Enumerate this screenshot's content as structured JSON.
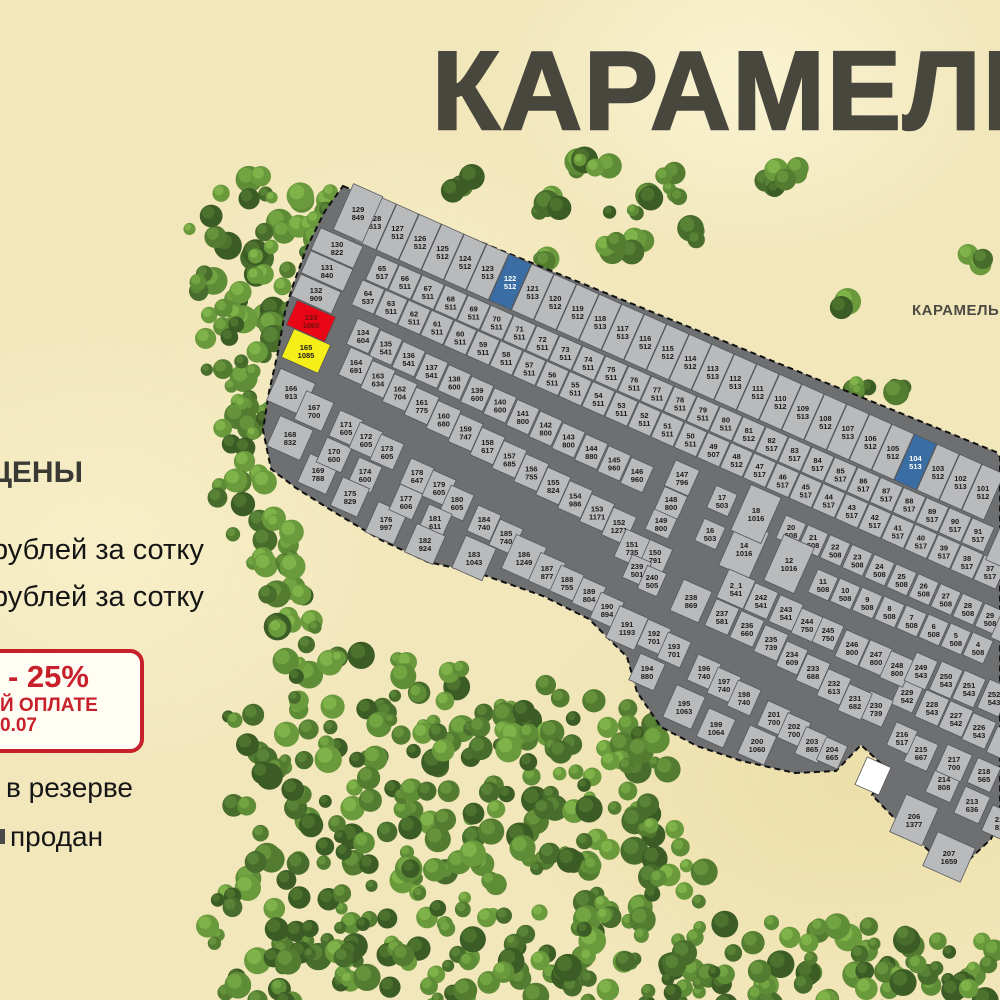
{
  "title": "КАРАМЕЛЬ",
  "secondary_area_label": "КАРАМЕЛЬ 2",
  "legend": {
    "prices_heading": "ЦЕНЫ",
    "price_line_1": "рублей за сотку",
    "price_line_2": "рублей за сотку",
    "promo": {
      "discount": "- 25%",
      "payment": "Й ОПЛАТЕ",
      "date": "0.07"
    },
    "status_reserved": "в резерве",
    "status_sold": "продан"
  },
  "colors": {
    "plot": "#b9babc",
    "road": "#6d6f71",
    "reserved_blue": "#3a6da4",
    "highlight_red": "#e80515",
    "highlight_yellow": "#f6ee19",
    "sold_white": "#ffffff",
    "promo_red": "#c8202a",
    "title_gray": "#48473e"
  },
  "map": {
    "plots": [
      [
        "129",
        "849"
      ],
      [
        "128",
        "513"
      ],
      [
        "127",
        "512"
      ],
      [
        "126",
        "512"
      ],
      [
        "125",
        "512"
      ],
      [
        "124",
        "512"
      ],
      [
        "123",
        "513"
      ],
      [
        "122",
        "512",
        "blue"
      ],
      [
        "121",
        "513"
      ],
      [
        "120",
        "512"
      ],
      [
        "119",
        "512"
      ],
      [
        "118",
        "513"
      ],
      [
        "117",
        "513"
      ],
      [
        "116",
        "512"
      ],
      [
        "115",
        "512"
      ],
      [
        "114",
        "512"
      ],
      [
        "113",
        "513"
      ],
      [
        "112",
        "513"
      ],
      [
        "111",
        "512"
      ],
      [
        "110",
        "512"
      ],
      [
        "109",
        "513"
      ],
      [
        "108",
        "512"
      ],
      [
        "107",
        "513"
      ],
      [
        "106",
        "512"
      ],
      [
        "105",
        "512"
      ],
      [
        "104",
        "513",
        "blue"
      ],
      [
        "103",
        "512"
      ],
      [
        "102",
        "513"
      ],
      [
        "101",
        "512"
      ],
      [
        "130",
        "822"
      ],
      [
        "131",
        "840"
      ],
      [
        "132",
        "909"
      ],
      [
        "133",
        "1060",
        "red"
      ],
      [
        "165",
        "1085",
        "yellow"
      ],
      [
        "166",
        "913"
      ],
      [
        "167",
        "700"
      ],
      [
        "168",
        "832"
      ],
      [
        "65",
        "517"
      ],
      [
        "66",
        "511"
      ],
      [
        "67",
        "511"
      ],
      [
        "68",
        "511"
      ],
      [
        "69",
        "511"
      ],
      [
        "70",
        "511"
      ],
      [
        "71",
        "511"
      ],
      [
        "72",
        "511"
      ],
      [
        "73",
        "511"
      ],
      [
        "74",
        "511"
      ],
      [
        "75",
        "511"
      ],
      [
        "76",
        "511"
      ],
      [
        "77",
        "511"
      ],
      [
        "78",
        "511"
      ],
      [
        "79",
        "511"
      ],
      [
        "80",
        "511"
      ],
      [
        "81",
        "512"
      ],
      [
        "82",
        "517"
      ],
      [
        "83",
        "517"
      ],
      [
        "84",
        "517"
      ],
      [
        "85",
        "517"
      ],
      [
        "86",
        "517"
      ],
      [
        "87",
        "517"
      ],
      [
        "88",
        "517"
      ],
      [
        "89",
        "517"
      ],
      [
        "90",
        "517"
      ],
      [
        "91",
        "517"
      ],
      [
        "64",
        "537"
      ],
      [
        "63",
        "511"
      ],
      [
        "62",
        "511"
      ],
      [
        "61",
        "511"
      ],
      [
        "60",
        "511"
      ],
      [
        "59",
        "511"
      ],
      [
        "58",
        "511"
      ],
      [
        "57",
        "511"
      ],
      [
        "56",
        "511"
      ],
      [
        "55",
        "511"
      ],
      [
        "54",
        "511"
      ],
      [
        "53",
        "511"
      ],
      [
        "52",
        "511"
      ],
      [
        "51",
        "511"
      ],
      [
        "50",
        "511"
      ],
      [
        "49",
        "507"
      ],
      [
        "48",
        "512"
      ],
      [
        "47",
        "517"
      ],
      [
        "46",
        "517"
      ],
      [
        "45",
        "517"
      ],
      [
        "44",
        "517"
      ],
      [
        "43",
        "517"
      ],
      [
        "42",
        "517"
      ],
      [
        "41",
        "517"
      ],
      [
        "40",
        "517"
      ],
      [
        "39",
        "517"
      ],
      [
        "38",
        "517"
      ],
      [
        "37",
        "517"
      ],
      [
        "134",
        "604"
      ],
      [
        "135",
        "541"
      ],
      [
        "136",
        "541"
      ],
      [
        "137",
        "541"
      ],
      [
        "138",
        "600"
      ],
      [
        "139",
        "600"
      ],
      [
        "140",
        "600"
      ],
      [
        "141",
        "800"
      ],
      [
        "142",
        "800"
      ],
      [
        "143",
        "800"
      ],
      [
        "144",
        "880"
      ],
      [
        "145",
        "960"
      ],
      [
        "146",
        "960"
      ],
      [
        "147",
        "796"
      ],
      [
        "17",
        "503"
      ],
      [
        "18",
        "1016"
      ],
      [
        "20",
        "508"
      ],
      [
        "21",
        "508"
      ],
      [
        "22",
        "508"
      ],
      [
        "23",
        "508"
      ],
      [
        "24",
        "508"
      ],
      [
        "25",
        "508"
      ],
      [
        "26",
        "508"
      ],
      [
        "27",
        "508"
      ],
      [
        "28",
        "508"
      ],
      [
        "29",
        "508"
      ],
      [
        "164",
        "691"
      ],
      [
        "163",
        "634"
      ],
      [
        "162",
        "704"
      ],
      [
        "161",
        "775"
      ],
      [
        "160",
        "680"
      ],
      [
        "159",
        "747"
      ],
      [
        "158",
        "617"
      ],
      [
        "157",
        "685"
      ],
      [
        "156",
        "755"
      ],
      [
        "155",
        "824"
      ],
      [
        "154",
        "986"
      ],
      [
        "153",
        "1171"
      ],
      [
        "152",
        "1271"
      ],
      [
        "151",
        "735"
      ],
      [
        "150",
        "791"
      ],
      [
        "149",
        "800"
      ],
      [
        "148",
        "800"
      ],
      [
        "16",
        "503"
      ],
      [
        "14",
        "1016"
      ],
      [
        "12",
        "1016"
      ],
      [
        "11",
        "508"
      ],
      [
        "10",
        "508"
      ],
      [
        "9",
        "508"
      ],
      [
        "8",
        "508"
      ],
      [
        "7",
        "508"
      ],
      [
        "6",
        "508"
      ],
      [
        "5",
        "508"
      ],
      [
        "4",
        "508"
      ],
      [
        "239",
        "501"
      ],
      [
        "240",
        "505"
      ],
      [
        "2_1",
        "541"
      ],
      [
        "242",
        "541"
      ],
      [
        "243",
        "541"
      ],
      [
        "244",
        "750"
      ],
      [
        "245",
        "750"
      ],
      [
        "246",
        "800"
      ],
      [
        "247",
        "800"
      ],
      [
        "248",
        "800"
      ],
      [
        "249",
        "543"
      ],
      [
        "250",
        "543"
      ],
      [
        "251",
        "543"
      ],
      [
        "252",
        "543"
      ],
      [
        "238",
        "869"
      ],
      [
        "237",
        "581"
      ],
      [
        "236",
        "660"
      ],
      [
        "235",
        "739"
      ],
      [
        "234",
        "609"
      ],
      [
        "233",
        "688"
      ],
      [
        "232",
        "613"
      ],
      [
        "231",
        "682"
      ],
      [
        "230",
        "739"
      ],
      [
        "229",
        "542"
      ],
      [
        "228",
        "543"
      ],
      [
        "227",
        "542"
      ],
      [
        "226",
        "543"
      ],
      [
        "169",
        "788"
      ],
      [
        "170",
        "600"
      ],
      [
        "171",
        "605"
      ],
      [
        "172",
        "605"
      ],
      [
        "173",
        "605"
      ],
      [
        "174",
        "600"
      ],
      [
        "175",
        "829"
      ],
      [
        "176",
        "997"
      ],
      [
        "177",
        "606"
      ],
      [
        "178",
        "647"
      ],
      [
        "179",
        "605"
      ],
      [
        "180",
        "605"
      ],
      [
        "181",
        "611"
      ],
      [
        "182",
        "924"
      ],
      [
        "183",
        "1043"
      ],
      [
        "184",
        "740"
      ],
      [
        "185",
        "740"
      ],
      [
        "186",
        "1249"
      ],
      [
        "187",
        "877"
      ],
      [
        "188",
        "755"
      ],
      [
        "189",
        "804"
      ],
      [
        "190",
        "894"
      ],
      [
        "191",
        "1193"
      ],
      [
        "192",
        "701"
      ],
      [
        "193",
        "701"
      ],
      [
        "194",
        "880"
      ],
      [
        "195",
        "1063"
      ],
      [
        "196",
        "740"
      ],
      [
        "197",
        "740"
      ],
      [
        "198",
        "740"
      ],
      [
        "199",
        "1064"
      ],
      [
        "200",
        "1060"
      ],
      [
        "201",
        "700"
      ],
      [
        "202",
        "700"
      ],
      [
        "203",
        "865"
      ],
      [
        "204",
        "665"
      ],
      [
        "206",
        "1377"
      ],
      [
        "207",
        "1659"
      ],
      [
        "213",
        "636"
      ],
      [
        "214",
        "808"
      ],
      [
        "215",
        "667"
      ],
      [
        "216",
        "517"
      ],
      [
        "217",
        "700"
      ],
      [
        "218",
        "565"
      ]
    ],
    "sold_plot": {
      "n": "",
      "a": "",
      "c": "white"
    },
    "partial_edge_plot": {
      "n": "21",
      "a": "81"
    }
  }
}
